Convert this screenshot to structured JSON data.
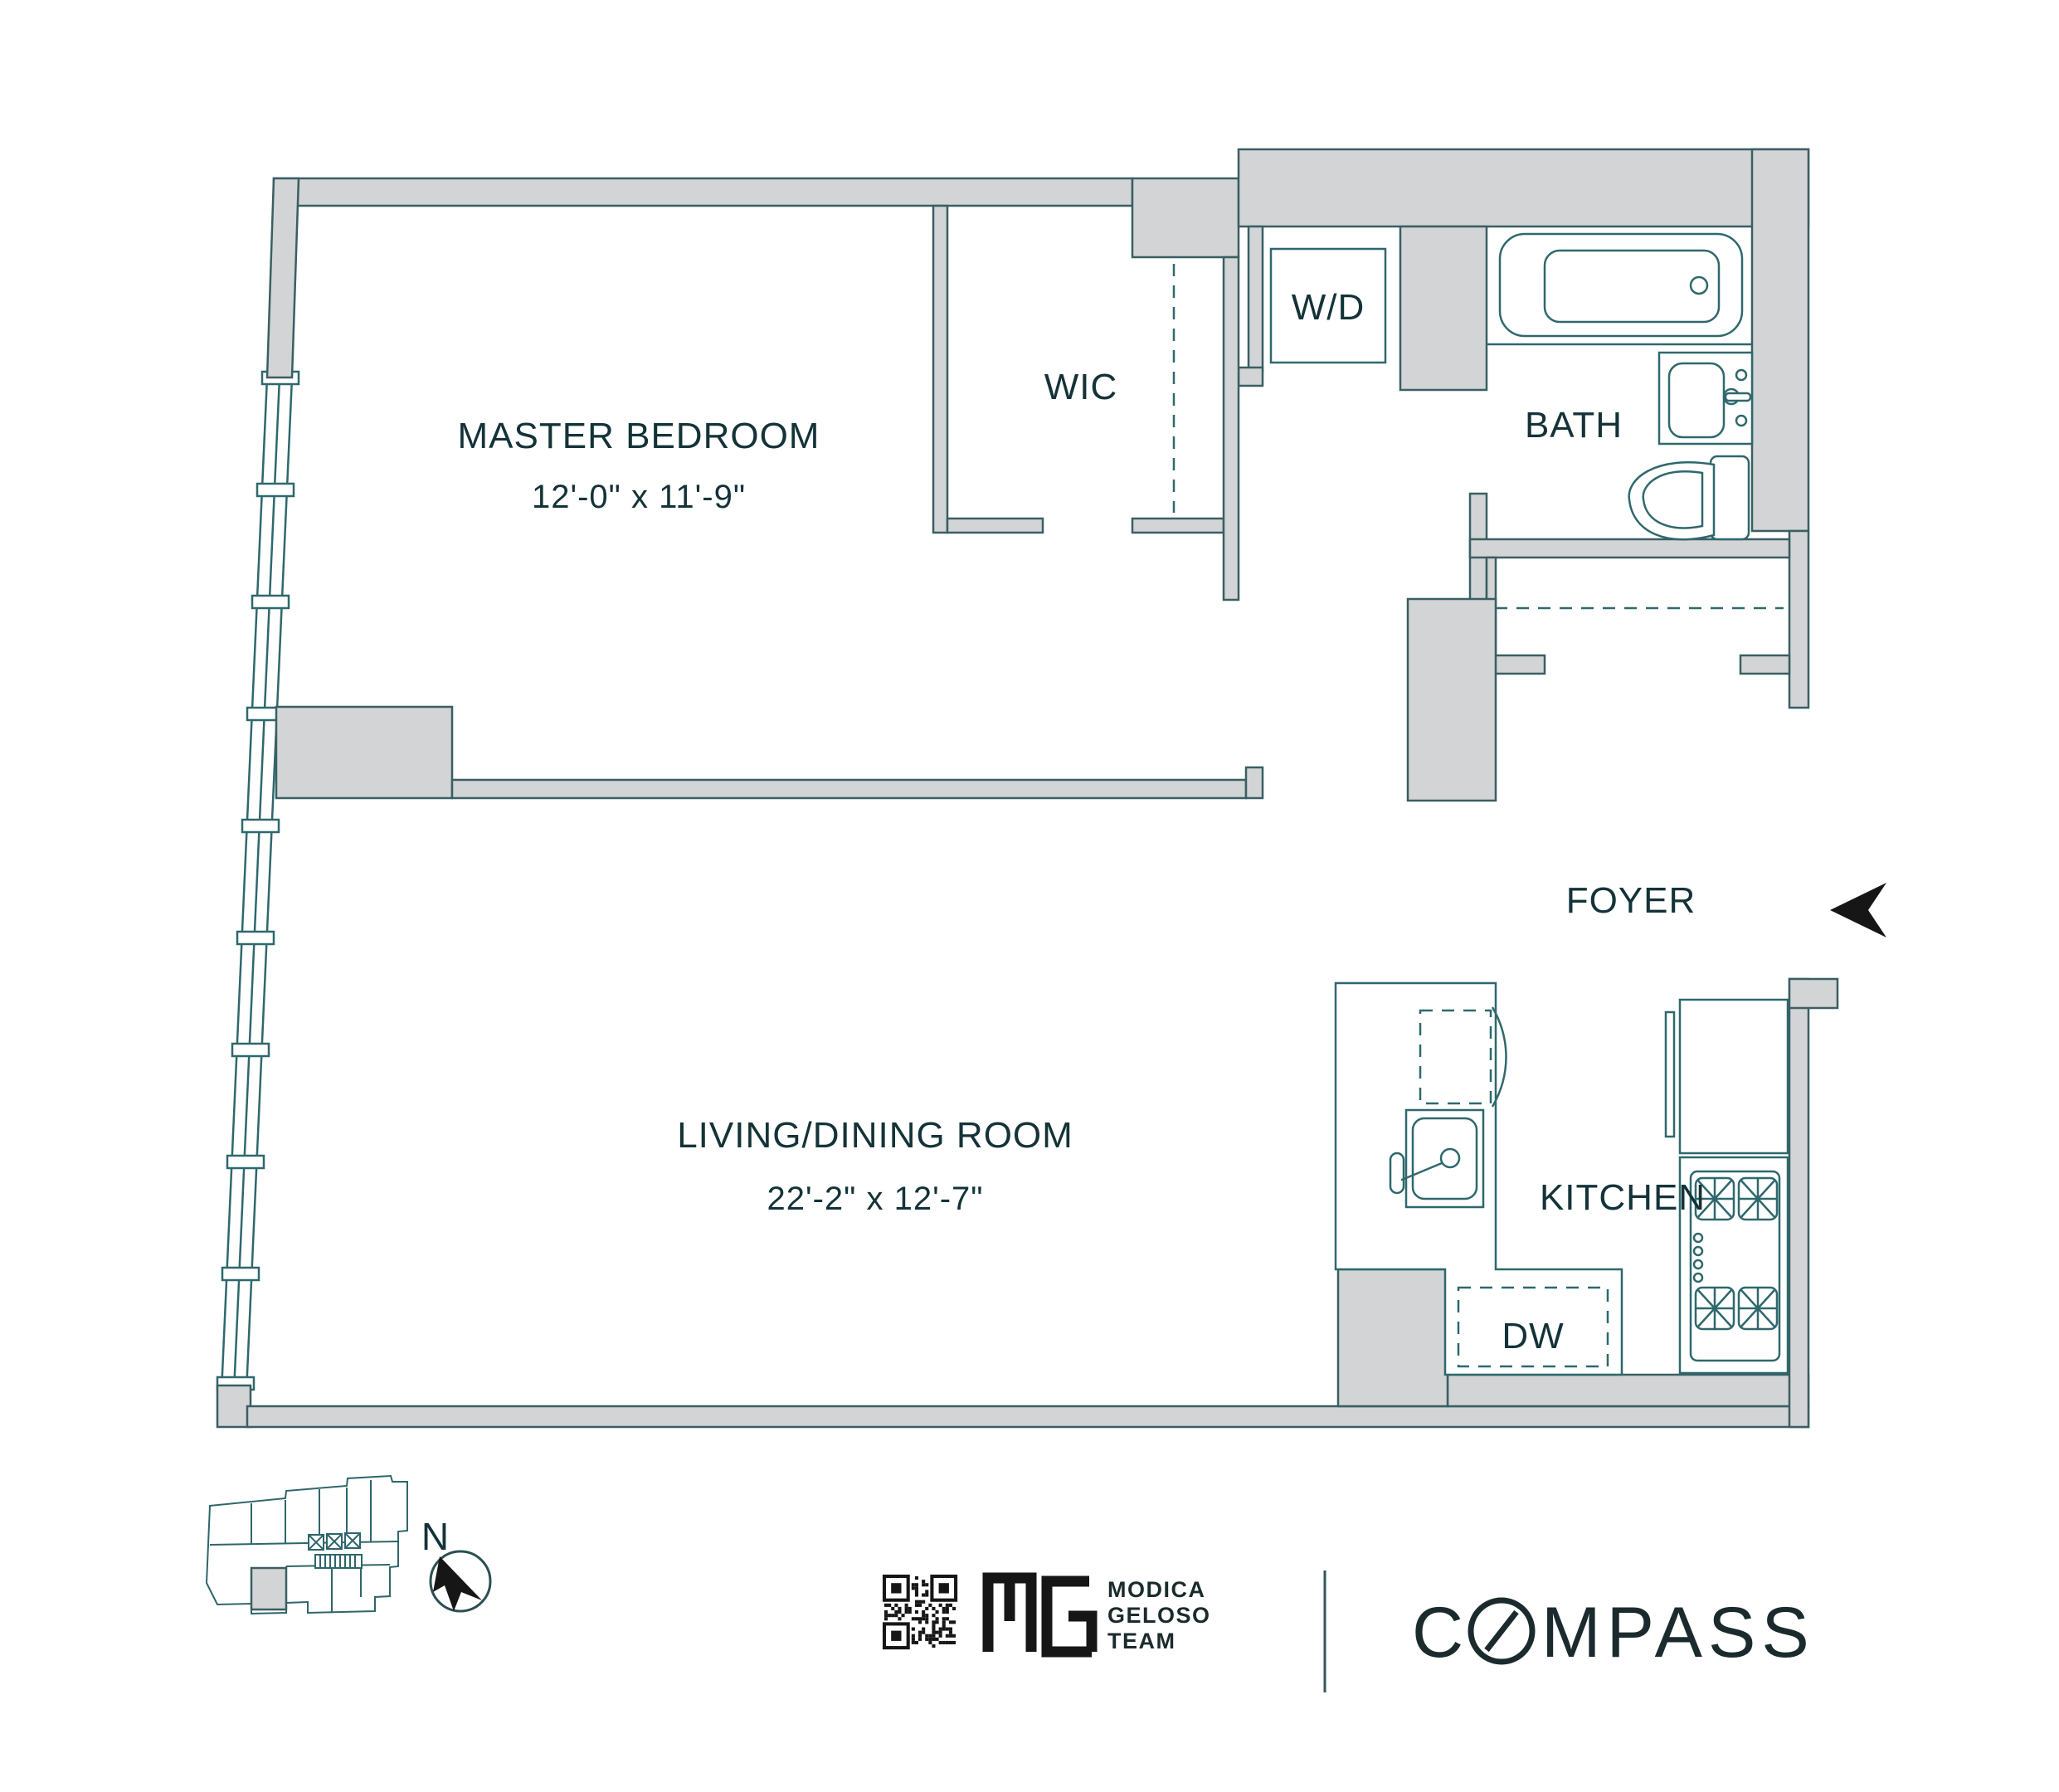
{
  "floor_plan": {
    "rooms": {
      "master_bedroom": {
        "label": "MASTER BEDROOM",
        "dimensions": "12'-0\" x 11'-9\""
      },
      "wic": {
        "label": "WIC"
      },
      "washer_dryer": {
        "label": "W/D"
      },
      "bath": {
        "label": "BATH"
      },
      "foyer": {
        "label": "FOYER"
      },
      "living_dining": {
        "label": "LIVING/DINING ROOM",
        "dimensions": "22'-2\" x 12'-7\""
      },
      "kitchen": {
        "label": "KITCHEN"
      },
      "dishwasher": {
        "label": "DW"
      }
    },
    "north_indicator": {
      "label": "N"
    },
    "fixtures": [
      "bathtub",
      "bathroom-sink",
      "toilet",
      "foyer-closet-rod",
      "wic-closet-rod",
      "kitchen-sink",
      "dishwasher-dashed",
      "refrigerator",
      "range-burners",
      "entry-arrow",
      "window-wall"
    ],
    "colors": {
      "wall_fill": "#d2d4d5",
      "line": "#3a5f63",
      "text": "#143338",
      "logo_black": "#161616"
    }
  },
  "footer": {
    "team_logo_lines": [
      "MODICA",
      "GELOSO",
      "TEAM"
    ],
    "brokerage": "COMPASS"
  }
}
